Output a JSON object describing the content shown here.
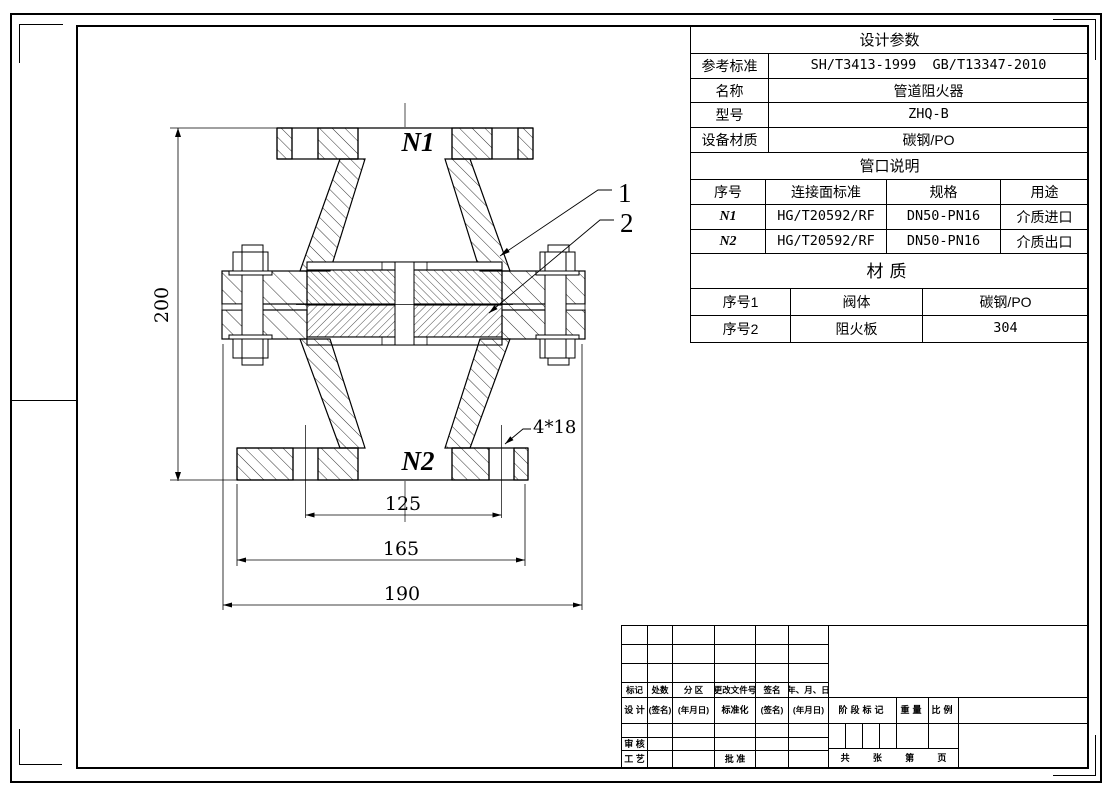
{
  "param_table": {
    "title": "设计参数",
    "rows": [
      {
        "label": "参考标准",
        "value": "SH/T3413-1999  GB/T13347-2010"
      },
      {
        "label": "名称",
        "value": "管道阻火器"
      },
      {
        "label": "型号",
        "value": "ZHQ-B"
      },
      {
        "label": "设备材质",
        "value": "碳钢/PO"
      }
    ],
    "nozzle_title": "管口说明",
    "nozzle_headers": [
      "序号",
      "连接面标准",
      "规格",
      "用途"
    ],
    "nozzle_rows": [
      [
        "N1",
        "HG/T20592/RF",
        "DN50-PN16",
        "介质进口"
      ],
      [
        "N2",
        "HG/T20592/RF",
        "DN50-PN16",
        "介质出口"
      ]
    ],
    "material_title": "材质",
    "material_rows": [
      [
        "序号1",
        "阀体",
        "碳钢/PO"
      ],
      [
        "序号2",
        "阻火板",
        "304"
      ]
    ]
  },
  "drawing": {
    "labels": {
      "n1": "N1",
      "n2": "N2",
      "part1": "1",
      "part2": "2",
      "bolt_holes": "4*18"
    },
    "dims": {
      "height": "200",
      "bolt_circle": "125",
      "flange_od": "165",
      "housing_od": "190"
    }
  },
  "title_block": {
    "change_headers": [
      "标记",
      "处数",
      "分 区",
      "更改文件号",
      "签名",
      "年、月、日"
    ],
    "sign_row": [
      "设 计",
      "(签名)",
      "(年月日)",
      "标准化",
      "(签名)",
      "(年月日)"
    ],
    "audit": "审 核",
    "craft": "工 艺",
    "approve": "批 准",
    "stage_mark": "阶段标记",
    "weight": "重量",
    "scale": "比例",
    "sheet_total": "共",
    "sheet_zhang": "张",
    "sheet_no": "第",
    "sheet_page": "页"
  }
}
